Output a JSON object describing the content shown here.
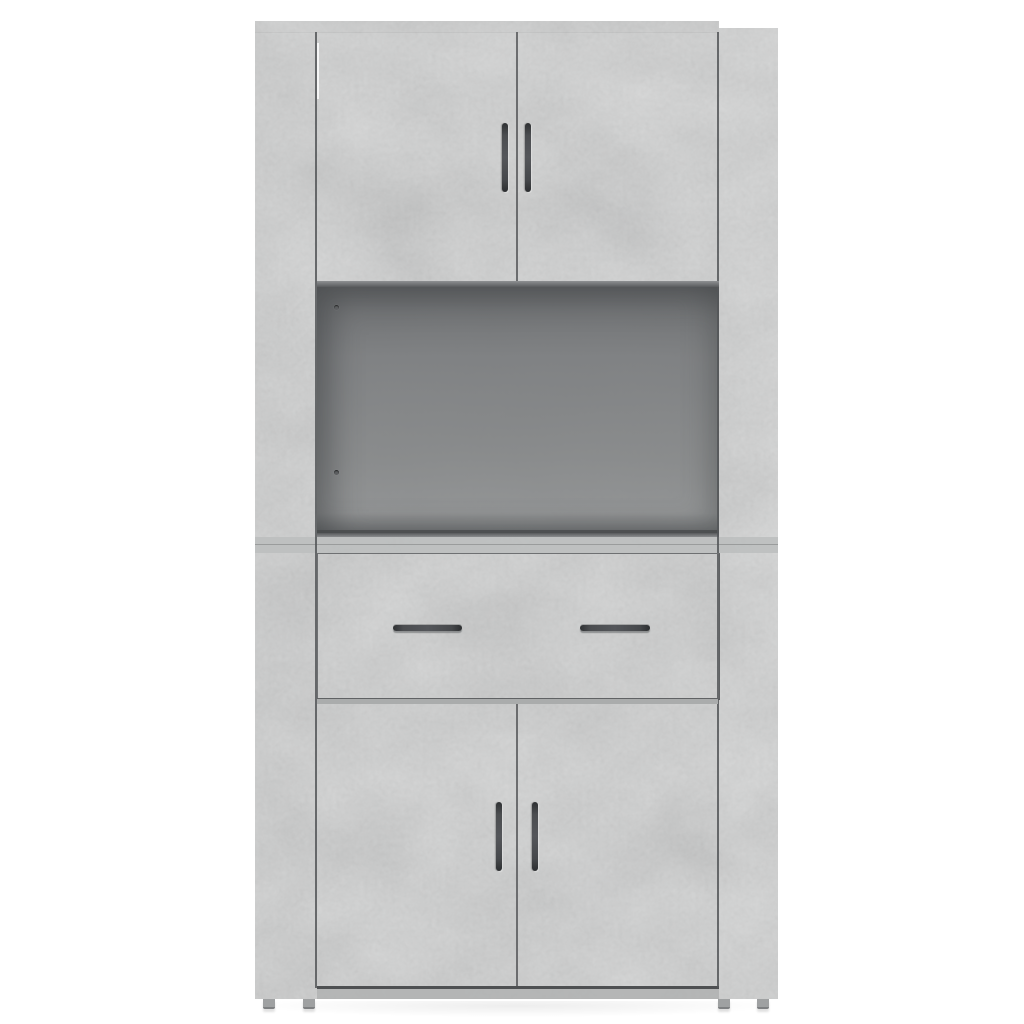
{
  "meta": {
    "kind": "product-photo",
    "description": "Front view of a tall concrete-grey highboard cabinet on a plain white background",
    "background_color": "#ffffff"
  },
  "product": {
    "name": "Highboard cabinet, concrete grey",
    "finish": "concrete grey",
    "counts": {
      "doors": 4,
      "drawers": 1,
      "open_compartments": 1,
      "handles": 6,
      "visible_feet": 4,
      "shelf_pin_holes": 2
    },
    "parts": {
      "cabinet": "Concrete grey highboard cabinet",
      "left_side_panel": "Left side panel",
      "right_side_panel": "Right side panel",
      "top_edge": "Cabinet top edge",
      "top_left_door": "Upper left door",
      "top_right_door": "Upper right door",
      "open_compartment": "Open middle compartment",
      "shelf_pin_hole": "Shelf pin hole",
      "drawer": "Drawer",
      "drawer_handle_left": "Left drawer handle",
      "drawer_handle_right": "Right drawer handle",
      "bottom_left_door": "Lower left door",
      "bottom_right_door": "Lower right door",
      "door_handle": "Dark grey bar handle",
      "plinth": "Base plinth",
      "foot": "Cabinet foot"
    }
  },
  "colors": {
    "panel_grey": "#b5b7b7",
    "panel_grey_light": "#c3c5c5",
    "panel_grey_dark": "#a4a6a6",
    "right_panel_grey": "#bcbebe",
    "recess_top": "#686a6c",
    "recess_bottom": "#8a8c8d",
    "seam_line": "#545658",
    "handle_dark": "#3a3c3e",
    "plinth_grey": "#b0b2b2",
    "foot_grey": "#9fa1a2",
    "background": "#ffffff"
  }
}
